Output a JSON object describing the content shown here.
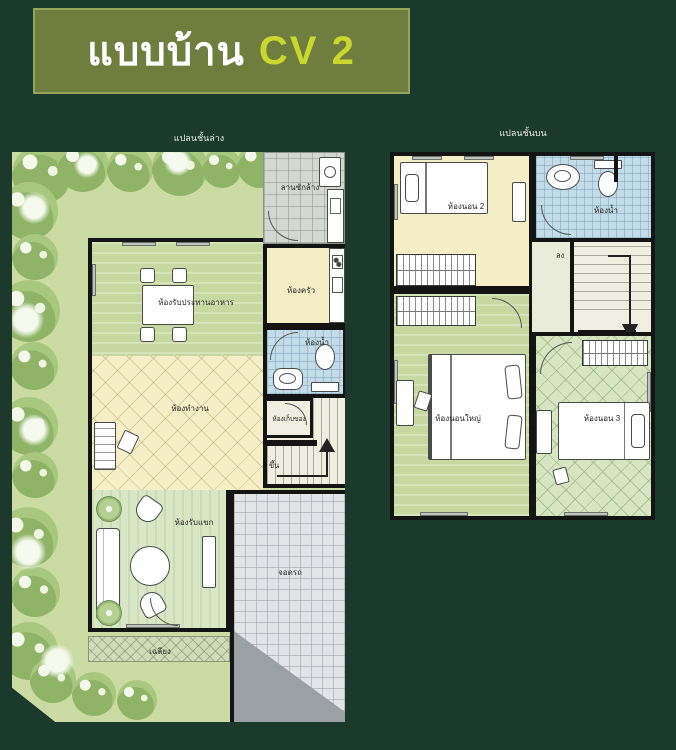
{
  "title": {
    "name_label": "แบบบ้าน",
    "model": "CV 2"
  },
  "ground_floor": {
    "plan_label": "แปลนชั้นล่าง",
    "washing_yard": "ลานซักล้าง",
    "kitchen": "ห้องครัว",
    "dining_room": "ห้องรับประทานอาหาร",
    "bathroom": "ห้องน้ำ",
    "storage": "ห้องเก็บของ",
    "work_room": "ห้องทำงาน",
    "living_room": "ห้องรับแขก",
    "porch": "เฉลียง",
    "parking": "จอดรถ",
    "stairs_up": "ขึ้น"
  },
  "upper_floor": {
    "plan_label": "แปลนชั้นบน",
    "bedroom_2": "ห้องนอน 2",
    "bathroom": "ห้องน้ำ",
    "master_bedroom": "ห้องนอนใหญ่",
    "bedroom_3": "ห้องนอน 3",
    "stairs_down": "ลง"
  },
  "colors": {
    "background": "#1b392c",
    "banner": "#6f7d3e",
    "banner_border": "#97a45c",
    "title_text": "#ffffff",
    "model_text": "#c9d72f",
    "garden": "#cbdba3",
    "wall": "#141414",
    "room_yellow": "#f4efc6",
    "room_green_stripe": "#c7d9a0",
    "living_green": "#d9e7c7",
    "bathroom_blue": "#c3dce8",
    "parking_gray": "#e3e4e7",
    "driveway_gray": "#9aa0a3",
    "wash_yard_gray": "#d5d7d1"
  }
}
